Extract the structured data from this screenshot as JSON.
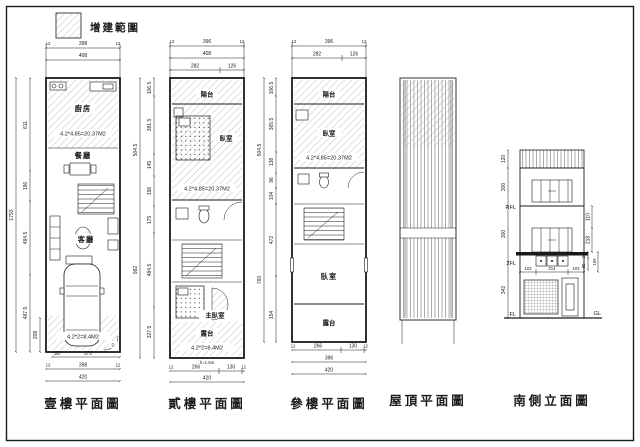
{
  "legend": {
    "label": "增建範圍"
  },
  "floor1": {
    "title": "壹樓平面圖",
    "top": {
      "l": "12",
      "c": "398",
      "r": "12",
      "w": "408"
    },
    "left": {
      "total": "1793",
      "s1": "611",
      "s2": "196",
      "s3": "484.5",
      "s4": "487.5",
      "inner": "208"
    },
    "rooms": {
      "kitchen": "廚房",
      "kitchen_area": "4.2*4.85=20.37M2",
      "dining": "餐廳",
      "living": "客廳",
      "garage_area": "4.2*2=8.4M2"
    },
    "labels": {
      "sd": "SD",
      "door": "D"
    },
    "bottom": {
      "d1": "372",
      "l": "12",
      "c": "398",
      "r": "12",
      "w": "420"
    }
  },
  "floor2": {
    "title": "貳樓平面圖",
    "top": {
      "l": "12",
      "c": "396",
      "r": "12",
      "w": "408",
      "a": "282",
      "b": "126"
    },
    "left": {
      "s1": "106.5",
      "s2": "381.5",
      "s3": "145",
      "s4": "196",
      "s5": "175",
      "s6": "484.5",
      "s7": "327.5",
      "o1": "504.5",
      "o2": "982"
    },
    "rooms": {
      "balcony": "陽台",
      "bedroom": "臥室",
      "bedroom_area": "4.2*4.85=20.37M2",
      "master": "主臥室",
      "terrace": "露台",
      "terrace_area": "4.2*2=8.4M2"
    },
    "note": "h=1.5m",
    "bottom": {
      "l": "12",
      "a": "266",
      "b": "130",
      "r": "12",
      "w": "420"
    }
  },
  "floor3": {
    "title": "參樓平面圖",
    "top": {
      "l": "12",
      "c": "396",
      "r": "12",
      "a": "282",
      "b": "126"
    },
    "left": {
      "s1": "106.5",
      "s2": "365.5",
      "s3": "138",
      "s4": "96",
      "s5": "104",
      "s6": "472",
      "s7": "154",
      "o1": "504.5",
      "o2": "760"
    },
    "rooms": {
      "balcony": "陽台",
      "bedroom": "臥室",
      "bedroom_area": "4.2*4.85=20.37M2",
      "bedroom2": "臥室",
      "terrace": "露台"
    },
    "bottom": {
      "l": "12",
      "a": "266",
      "b": "130",
      "r": "12",
      "w1": "396",
      "w2": "420"
    }
  },
  "roof": {
    "title": "屋頂平面圖"
  },
  "elevation": {
    "title": "南側立面圖",
    "levels": {
      "rfl": "RFL",
      "f2": "2FL",
      "fl": "FL",
      "gl": "GL"
    },
    "left": {
      "s1": "120",
      "s2": "300",
      "s3": "300",
      "s4": "342"
    },
    "right": {
      "s1": "110",
      "s2": "218",
      "s3": "80",
      "s4": "26",
      "s5": "159"
    },
    "bottom": {
      "a": "103",
      "b": "214",
      "c": "103"
    }
  }
}
